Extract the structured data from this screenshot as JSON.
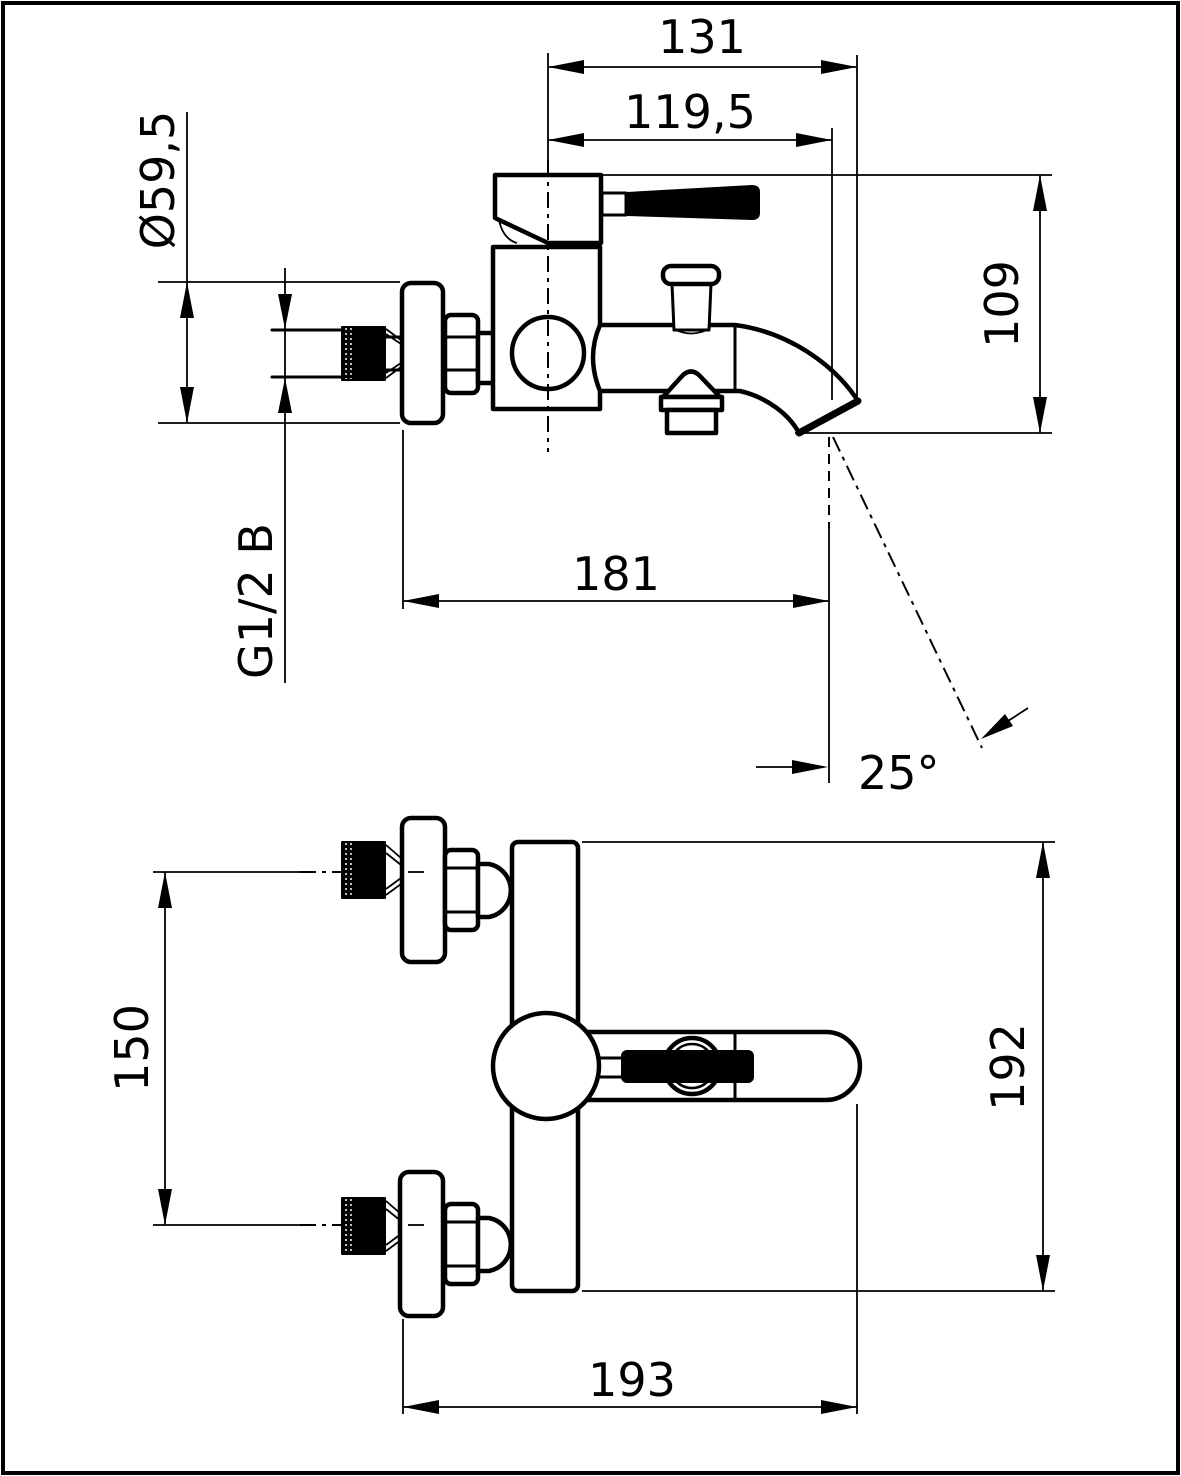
{
  "drawing": {
    "kind": "bath-mixer-faucet technical drawing",
    "views": {
      "side": "side-view",
      "front": "front-view"
    },
    "colors": {
      "line": "#000000",
      "background": "#ffffff"
    }
  },
  "dimensions": {
    "overall_depth": "131",
    "outlet_center_depth": "119,5",
    "escutcheon_diameter": "Ø59,5",
    "body_to_outlet_height": "109",
    "wall_to_outlet_depth": "181",
    "spout_angle": "25°",
    "connection_thread": "G1/2 B",
    "inlet_spacing": "150",
    "overall_height": "192",
    "overall_width": "193"
  }
}
